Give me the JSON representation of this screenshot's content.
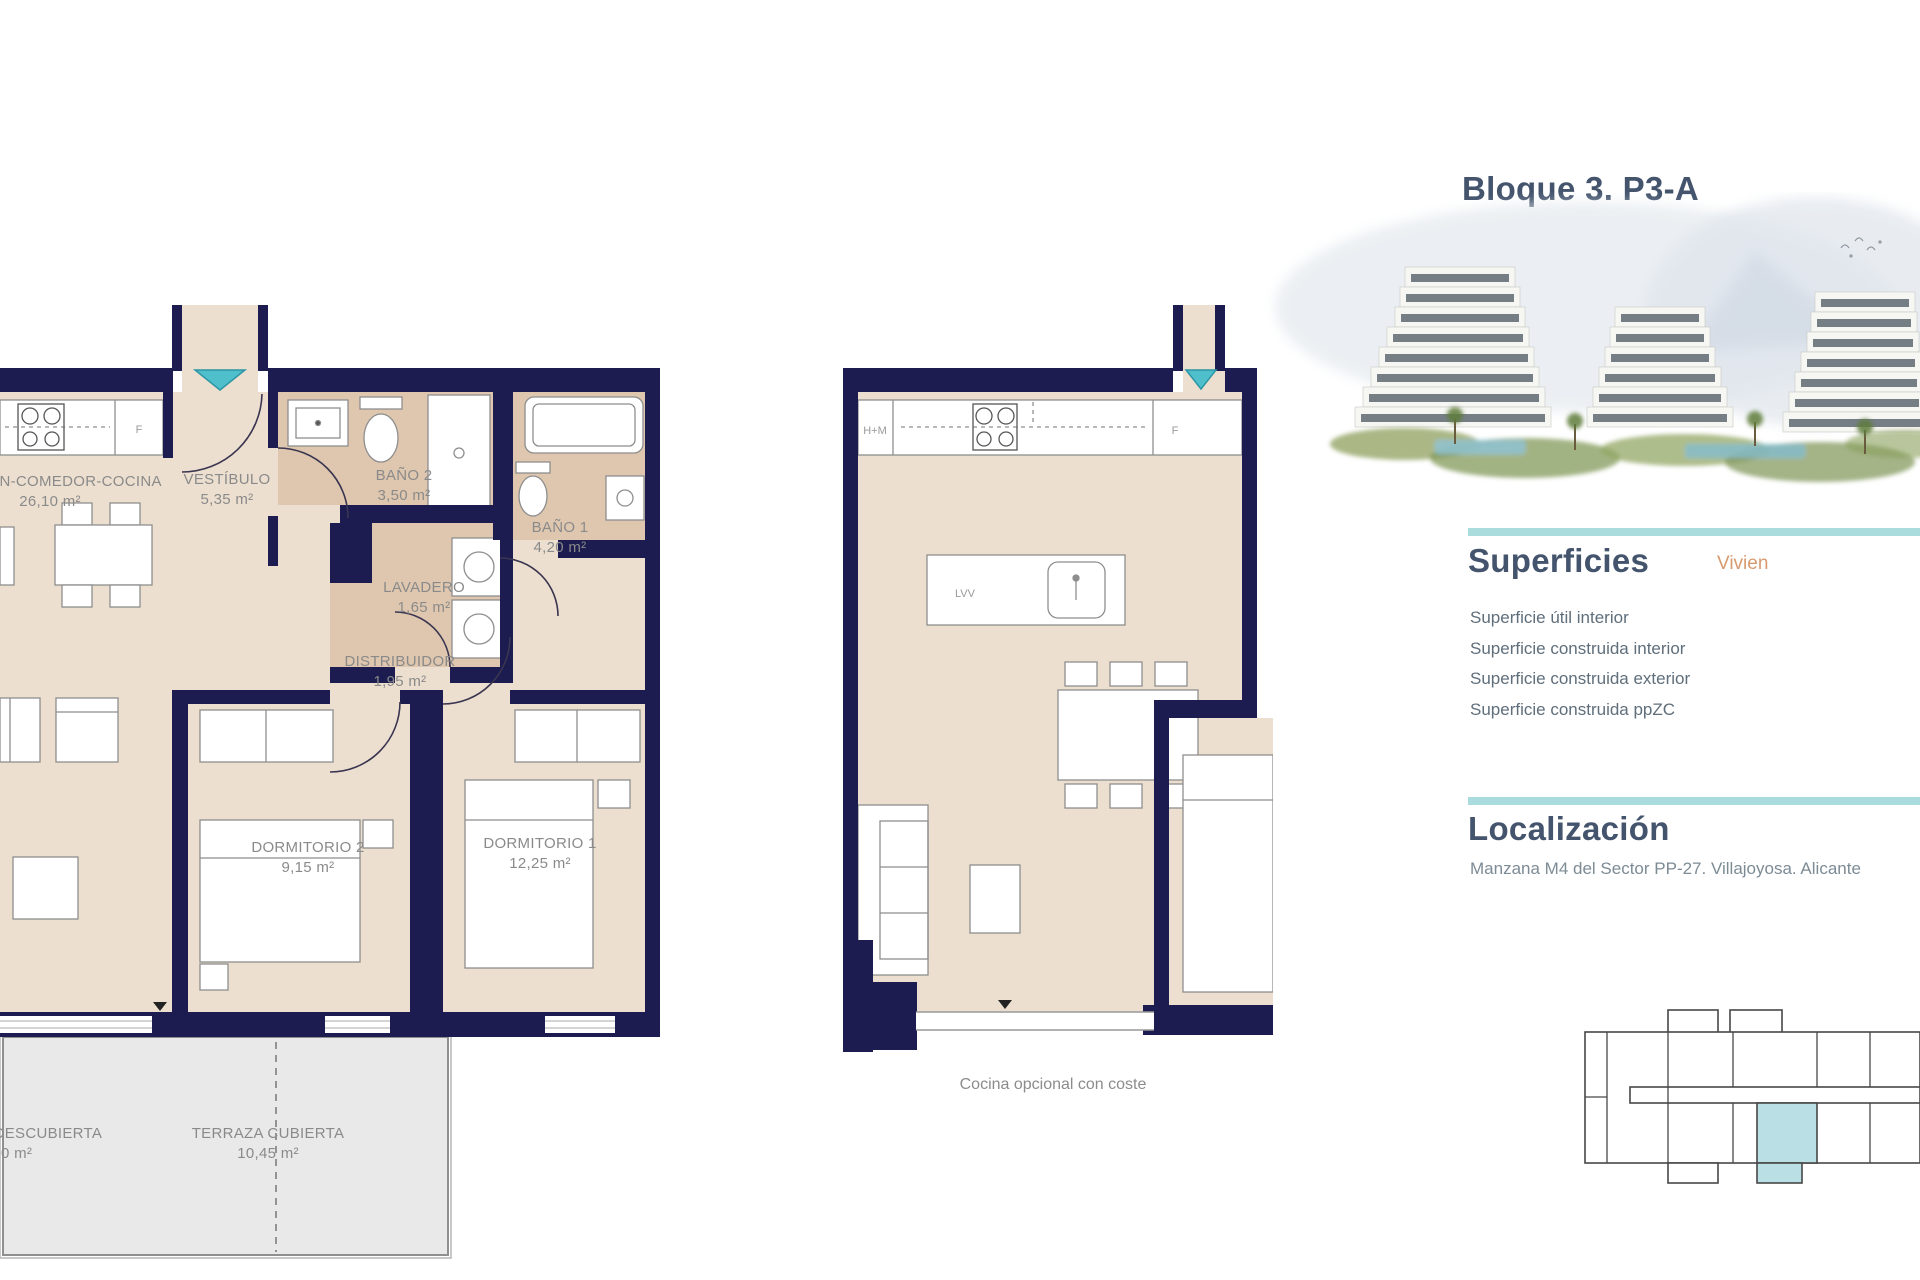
{
  "title": "Bloque 3. P3-A",
  "superficies": {
    "heading": "Superficies",
    "column_label": "Vivien",
    "rows": [
      "Superficie útil interior",
      "Superficie construida interior",
      "Superficie construida exterior",
      "Superficie construida ppZC"
    ]
  },
  "localizacion": {
    "heading": "Localización",
    "address": "Manzana M4 del Sector PP-27. Villajoyosa. Alicante"
  },
  "plan_main": {
    "rooms": {
      "salon": {
        "label": "SALÓN-COMEDOR-COCINA",
        "area": "26,10 m²"
      },
      "vestibulo": {
        "label": "VESTÍBULO",
        "area": "5,35 m²"
      },
      "bano2": {
        "label": "BAÑO 2",
        "area": "3,50 m²"
      },
      "bano1": {
        "label": "BAÑO 1",
        "area": "4,20 m²"
      },
      "lavadero": {
        "label": "LAVADERO",
        "area": "1,65 m²"
      },
      "distribuidor": {
        "label": "DISTRIBUIDOR",
        "area": "1,95 m²"
      },
      "dormitorio2": {
        "label": "DORMITORIO 2",
        "area": "9,15 m²"
      },
      "dormitorio1": {
        "label": "DORMITORIO 1",
        "area": "12,25 m²"
      },
      "terraza_cubierta": {
        "label": "TERRAZA CUBIERTA",
        "area": "10,45 m²"
      },
      "terraza_descubierta": {
        "label": "TERRAZA DESCUBIERTA",
        "area": "0 m²"
      }
    },
    "labels": {
      "fridge": "F"
    }
  },
  "plan_optional": {
    "caption": "Cocina opcional con coste",
    "labels": {
      "hm": "H+M",
      "fridge": "F",
      "lvv": "LVV"
    }
  },
  "colors": {
    "wall_navy": "#1c1c50",
    "floor_beige": "#ecdfcf",
    "floor_tan": "#dfc7af",
    "accent_teal_bar": "#aadcdd",
    "door_marker_teal": "#4fc0cb",
    "highlight_unit": "#badfe4",
    "heading_slate": "#44546d",
    "label_gray": "#8a8a8a",
    "orange": "#d79a6f"
  }
}
